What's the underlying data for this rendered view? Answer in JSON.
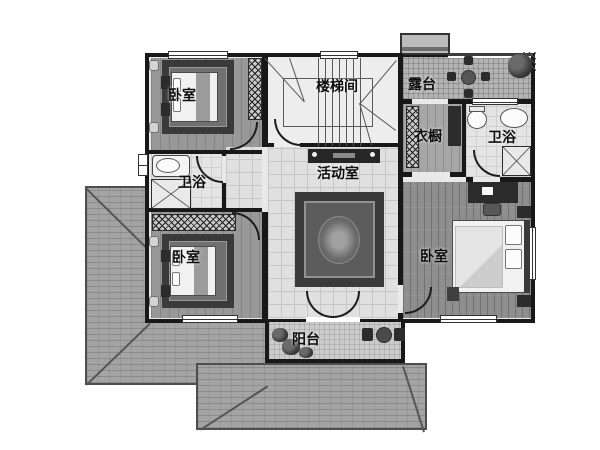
{
  "rooms": {
    "bedroom_top_left": {
      "label": "卧室"
    },
    "bathroom_left": {
      "label": "卫浴"
    },
    "bedroom_bottom_left": {
      "label": "卧室"
    },
    "stairwell": {
      "label": "楼梯间"
    },
    "activity_room": {
      "label": "活动室"
    },
    "terrace": {
      "label": "露台"
    },
    "wardrobe": {
      "label": "衣橱"
    },
    "bathroom_right": {
      "label": "卫浴"
    },
    "bedroom_right": {
      "label": "卧室"
    },
    "balcony": {
      "label": "阳台"
    }
  },
  "colors": {
    "wall": "#181818",
    "roof": "#9c9c9c",
    "tile_floor": "#e0e0e0",
    "wood_floor": "#8e8e8e",
    "plank_floor": "#989898",
    "terrace_floor": "#b3b3b3",
    "balcony_floor": "#cbcbcb",
    "carpet_border": "#3a3a3a",
    "carpet_field": "#707070",
    "background": "#ffffff"
  }
}
